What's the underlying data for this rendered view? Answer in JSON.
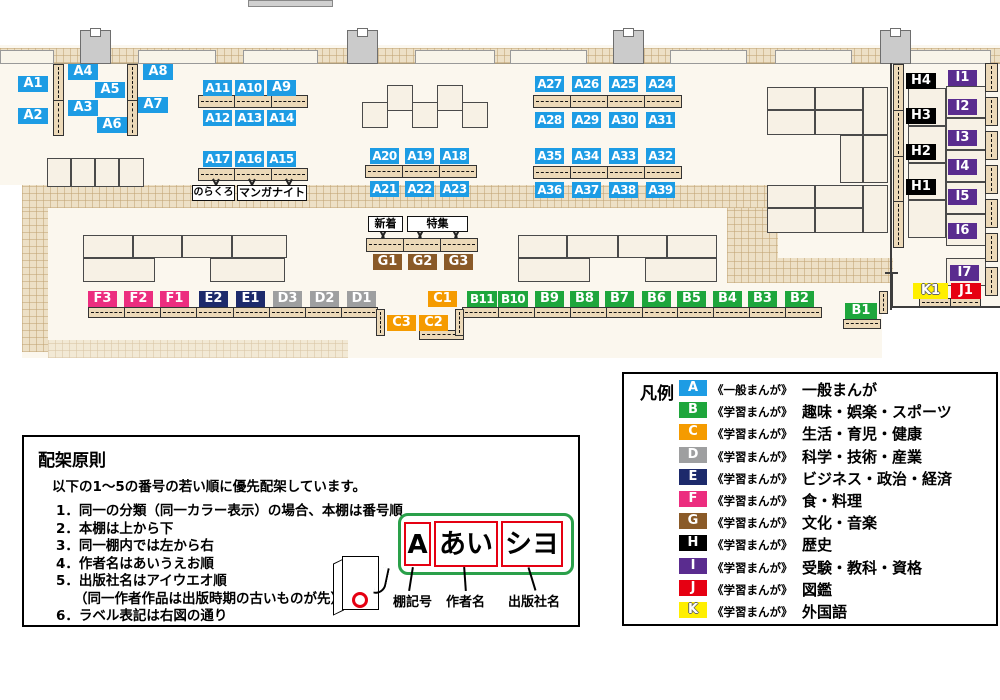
{
  "colors": {
    "A": "#1d9ce4",
    "B": "#1ea63c",
    "C": "#f59b00",
    "D": "#9e9fa0",
    "E": "#1d2a6b",
    "F": "#ec2d7f",
    "G": "#8a5a28",
    "H": "#000000",
    "I": "#5a2c8f",
    "J": "#e60012",
    "K": "#ffef00"
  },
  "map": {
    "shelves": [
      {
        "id": "A1",
        "x": 18,
        "y": 76,
        "w": 30
      },
      {
        "id": "A2",
        "x": 18,
        "y": 108,
        "w": 30
      },
      {
        "id": "A3",
        "x": 68,
        "y": 100,
        "w": 30
      },
      {
        "id": "A4",
        "x": 68,
        "y": 64,
        "w": 30
      },
      {
        "id": "A5",
        "x": 95,
        "y": 82,
        "w": 30
      },
      {
        "id": "A6",
        "x": 97,
        "y": 117,
        "w": 30
      },
      {
        "id": "A7",
        "x": 138,
        "y": 97,
        "w": 30
      },
      {
        "id": "A8",
        "x": 143,
        "y": 64,
        "w": 30
      },
      {
        "id": "A9",
        "x": 267,
        "y": 80
      },
      {
        "id": "A10",
        "x": 235,
        "y": 80
      },
      {
        "id": "A11",
        "x": 203,
        "y": 80
      },
      {
        "id": "A12",
        "x": 203,
        "y": 110
      },
      {
        "id": "A13",
        "x": 235,
        "y": 110
      },
      {
        "id": "A14",
        "x": 267,
        "y": 110
      },
      {
        "id": "A15",
        "x": 267,
        "y": 151
      },
      {
        "id": "A16",
        "x": 235,
        "y": 151
      },
      {
        "id": "A17",
        "x": 203,
        "y": 151
      },
      {
        "id": "A18",
        "x": 440,
        "y": 148
      },
      {
        "id": "A19",
        "x": 405,
        "y": 148
      },
      {
        "id": "A20",
        "x": 370,
        "y": 148
      },
      {
        "id": "A21",
        "x": 370,
        "y": 181
      },
      {
        "id": "A22",
        "x": 405,
        "y": 181
      },
      {
        "id": "A23",
        "x": 440,
        "y": 181
      },
      {
        "id": "A24",
        "x": 646,
        "y": 76
      },
      {
        "id": "A25",
        "x": 609,
        "y": 76
      },
      {
        "id": "A26",
        "x": 572,
        "y": 76
      },
      {
        "id": "A27",
        "x": 535,
        "y": 76
      },
      {
        "id": "A28",
        "x": 535,
        "y": 112
      },
      {
        "id": "A29",
        "x": 572,
        "y": 112
      },
      {
        "id": "A30",
        "x": 609,
        "y": 112
      },
      {
        "id": "A31",
        "x": 646,
        "y": 112
      },
      {
        "id": "A32",
        "x": 646,
        "y": 148
      },
      {
        "id": "A33",
        "x": 609,
        "y": 148
      },
      {
        "id": "A34",
        "x": 572,
        "y": 148
      },
      {
        "id": "A35",
        "x": 535,
        "y": 148
      },
      {
        "id": "A36",
        "x": 535,
        "y": 182
      },
      {
        "id": "A37",
        "x": 572,
        "y": 182
      },
      {
        "id": "A38",
        "x": 609,
        "y": 182
      },
      {
        "id": "A39",
        "x": 646,
        "y": 182
      },
      {
        "id": "B1",
        "x": 845,
        "y": 303,
        "w": 32
      },
      {
        "id": "B2",
        "x": 785,
        "y": 291
      },
      {
        "id": "B3",
        "x": 748,
        "y": 291
      },
      {
        "id": "B4",
        "x": 713,
        "y": 291
      },
      {
        "id": "B5",
        "x": 677,
        "y": 291
      },
      {
        "id": "B6",
        "x": 642,
        "y": 291
      },
      {
        "id": "B7",
        "x": 605,
        "y": 291
      },
      {
        "id": "B8",
        "x": 570,
        "y": 291
      },
      {
        "id": "B9",
        "x": 535,
        "y": 291
      },
      {
        "id": "B10",
        "x": 498,
        "y": 291,
        "w": 30
      },
      {
        "id": "B11",
        "x": 467,
        "y": 291,
        "w": 30
      },
      {
        "id": "C1",
        "x": 428,
        "y": 291
      },
      {
        "id": "C2",
        "x": 419,
        "y": 315
      },
      {
        "id": "C3",
        "x": 387,
        "y": 315
      },
      {
        "id": "D1",
        "x": 347,
        "y": 291
      },
      {
        "id": "D2",
        "x": 310,
        "y": 291
      },
      {
        "id": "D3",
        "x": 273,
        "y": 291
      },
      {
        "id": "E1",
        "x": 236,
        "y": 291
      },
      {
        "id": "E2",
        "x": 199,
        "y": 291
      },
      {
        "id": "F1",
        "x": 160,
        "y": 291
      },
      {
        "id": "F2",
        "x": 124,
        "y": 291
      },
      {
        "id": "F3",
        "x": 88,
        "y": 291
      },
      {
        "id": "G1",
        "x": 373,
        "y": 254
      },
      {
        "id": "G2",
        "x": 408,
        "y": 254
      },
      {
        "id": "G3",
        "x": 444,
        "y": 254
      },
      {
        "id": "H1",
        "x": 906,
        "y": 179,
        "w": 30
      },
      {
        "id": "H2",
        "x": 906,
        "y": 144,
        "w": 30
      },
      {
        "id": "H3",
        "x": 906,
        "y": 108,
        "w": 30
      },
      {
        "id": "H4",
        "x": 906,
        "y": 73,
        "w": 30
      },
      {
        "id": "I1",
        "x": 948,
        "y": 70
      },
      {
        "id": "I2",
        "x": 948,
        "y": 99
      },
      {
        "id": "I3",
        "x": 948,
        "y": 130
      },
      {
        "id": "I4",
        "x": 948,
        "y": 159
      },
      {
        "id": "I5",
        "x": 948,
        "y": 189
      },
      {
        "id": "I6",
        "x": 948,
        "y": 223
      },
      {
        "id": "I7",
        "x": 950,
        "y": 265
      },
      {
        "id": "J1",
        "x": 951,
        "y": 283,
        "w": 30
      },
      {
        "id": "K1",
        "x": 913,
        "y": 283,
        "w": 35
      }
    ],
    "callouts": {
      "norakuro": "のらくろ",
      "manganight": "マンガナイト",
      "new_arrivals": "新着",
      "feature": "特集"
    }
  },
  "legend": {
    "title": "凡例",
    "items": [
      {
        "letter": "A",
        "type": "《一般まんが》",
        "label": "一般まんが"
      },
      {
        "letter": "B",
        "type": "《学習まんが》",
        "label": "趣味・娯楽・スポーツ"
      },
      {
        "letter": "C",
        "type": "《学習まんが》",
        "label": "生活・育児・健康"
      },
      {
        "letter": "D",
        "type": "《学習まんが》",
        "label": "科学・技術・産業"
      },
      {
        "letter": "E",
        "type": "《学習まんが》",
        "label": "ビジネス・政治・経済"
      },
      {
        "letter": "F",
        "type": "《学習まんが》",
        "label": "食・料理"
      },
      {
        "letter": "G",
        "type": "《学習まんが》",
        "label": "文化・音楽"
      },
      {
        "letter": "H",
        "type": "《学習まんが》",
        "label": "歴史"
      },
      {
        "letter": "I",
        "type": "《学習まんが》",
        "label": "受験・教科・資格"
      },
      {
        "letter": "J",
        "type": "《学習まんが》",
        "label": "図鑑"
      },
      {
        "letter": "K",
        "type": "《学習まんが》",
        "label": "外国語"
      }
    ]
  },
  "principles": {
    "title": "配架原則",
    "intro": "以下の1～5の番号の若い順に優先配架しています。",
    "items": [
      "1．同一の分類（同一カラー表示）の場合、本棚は番号順",
      "2．本棚は上から下",
      "3．同一棚内では左から右",
      "4．作者名はあいうえお順",
      "5．出版社名はアイウエオ順",
      "6．ラベル表記は右図の通り"
    ],
    "note": "（同一作者作品は出版時期の古いものが先）",
    "diagram": {
      "segments": [
        "A",
        "あい",
        "シヨ"
      ],
      "captions": [
        "棚記号",
        "作者名",
        "出版社名"
      ]
    }
  }
}
